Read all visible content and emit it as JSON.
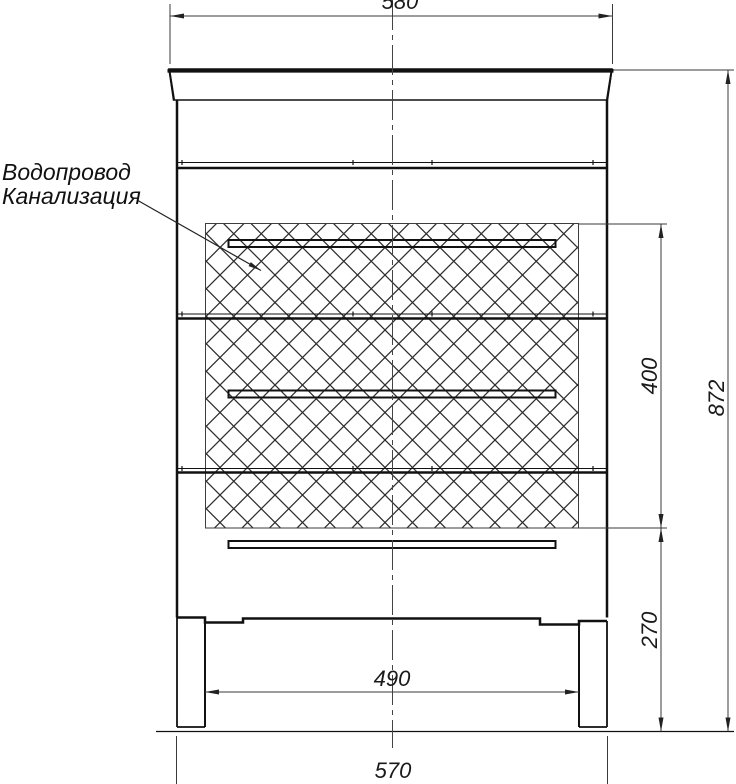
{
  "drawing_type": "bathroom-vanity-front-view-technical-drawing",
  "callout": {
    "line1": "Водопровод",
    "line2": "Канализация"
  },
  "dimensions": {
    "countertop_width": "580",
    "hatch_zone_height": "400",
    "overall_height": "872",
    "plinth_zone_height": "270",
    "legs_inner_width": "490",
    "cabinet_width": "570"
  },
  "colors": {
    "background": "#ffffff",
    "object_line": "#111111",
    "dimension_line": "#3a3a3a",
    "hatch_line": "#2e2e2e"
  }
}
